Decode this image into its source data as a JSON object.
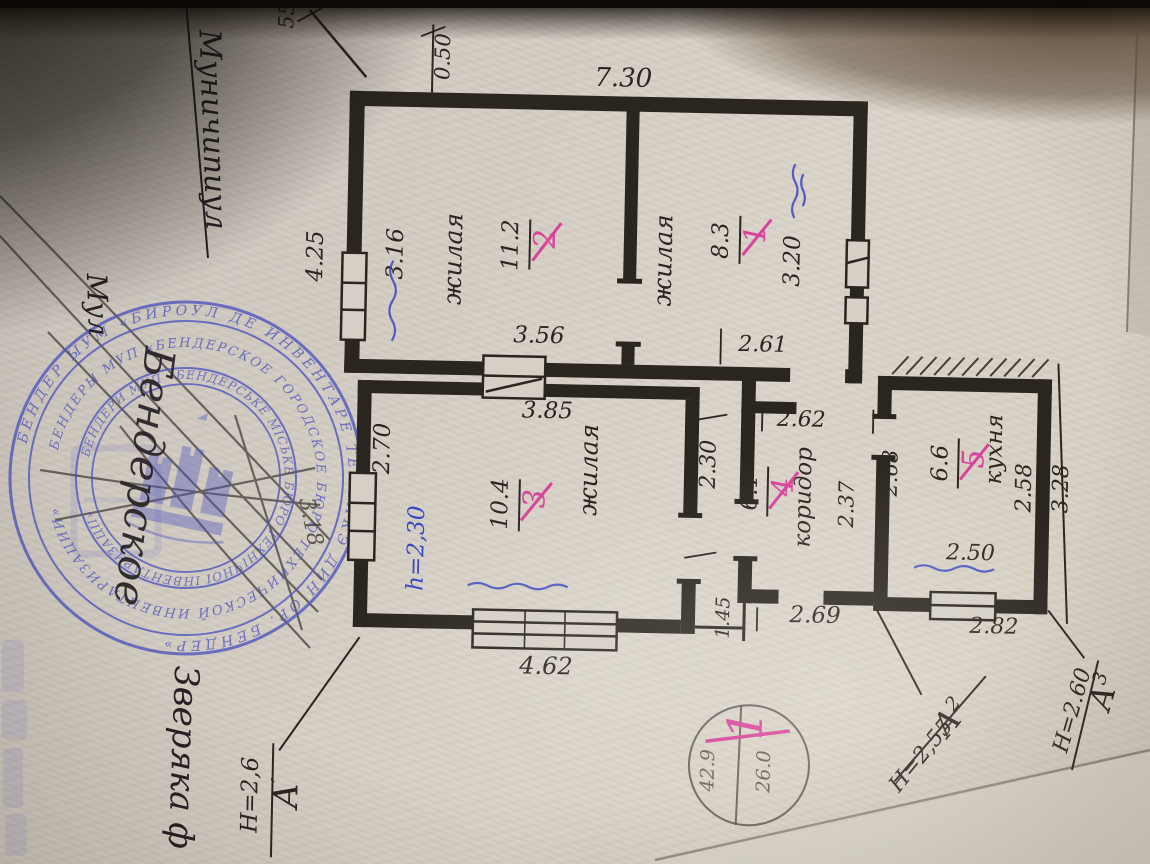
{
  "colors": {
    "ink": "#2b2520",
    "pencil": "#4a443c",
    "blue_pen": "#3a47c2",
    "red_marker": "#d8439b",
    "stamp_blue": "#5156bd",
    "paper": "#d5cfc6"
  },
  "rooms": [
    {
      "number": "1",
      "area": "8.3",
      "name": "жилая"
    },
    {
      "number": "2",
      "area": "11.2",
      "name": "жилая"
    },
    {
      "number": "3",
      "area": "10.4",
      "name": "жилая"
    },
    {
      "number": "4",
      "area": "6.1",
      "name": "коридор"
    },
    {
      "number": "5",
      "area": "6.6",
      "name": "кухня"
    }
  ],
  "dimensions": {
    "d_0_50": "0.50",
    "d_7_30": "7.30",
    "d_4_25": "4.25",
    "d_55": "55",
    "d_3_16": "3.16",
    "d_3_56": "3.56",
    "d_3_20": "3.20",
    "d_2_61": "2.61",
    "d_2_62": "2.62",
    "d_3_85": "3.85",
    "d_2_70": "2.70",
    "d_2_30": "2.30",
    "d_1_45": "1.45",
    "d_2_69": "2.69",
    "d_4_62": "4.62",
    "d_2_37": "2.37",
    "d_2_68": "2.68",
    "d_2_58": "2.58",
    "d_2_50": "2.50",
    "d_2_82": "2.82",
    "d_3_28": "3.28"
  },
  "markers": {
    "a1": {
      "letter": "А",
      "sup": "′",
      "height": "Н=2,6"
    },
    "a2": {
      "letter": "А",
      "sup": "2",
      "height": "Н=2,55"
    },
    "a3": {
      "letter": "А",
      "sup": "3",
      "height": "Н=2.60"
    },
    "circle": {
      "number": "1",
      "left_value": "42.9",
      "right_value": "26.0"
    }
  },
  "annotations": {
    "blue_height": "h=2,30",
    "pencil_note": "3.18",
    "handwriting_top": "Муничипиул",
    "handwriting_mid": "Мул",
    "handwriting_over_stamp": "Бендерское",
    "handwriting_bottom": "Зверяка ф"
  },
  "stamp": {
    "ring_outer": "БЕНДЕР ЫУМ «БИРОУЛ ДЕ ИНВЕНТАРЕ ТЕХНИКЭ ДИН ОР. БЕНДЕР»",
    "ring_middle": "БЕНДЕРЫ МУП «БЕНДЕРСКОЕ ГОРОДСКОЕ БЮРО ТЕХНИЧЕСКОЙ ИНВЕНТАРИЗАЦИИ»",
    "ring_inner": "БЕНДЕРИ МУП «БЕНДЕРСЬКЕ МІСЬКЕ БЮРО ТЕХНІЧНОЇ ІНВЕНТАРИЗАЦІЇ»"
  }
}
